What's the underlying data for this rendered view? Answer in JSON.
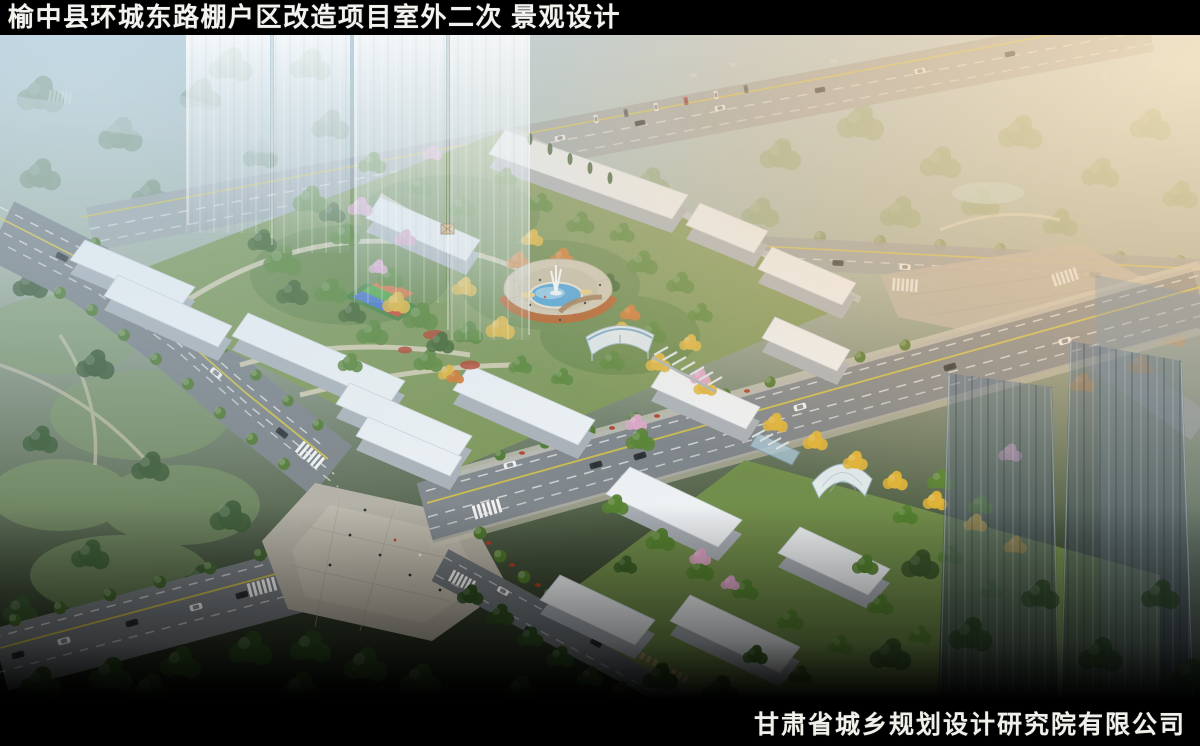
{
  "header": {
    "title": "榆中县环城东路棚户区改造项目室外二次 景观设计"
  },
  "footer": {
    "company": "甘肃省城乡规划设计研究院有限公司"
  },
  "scene": {
    "type": "aerial-landscape-rendering",
    "colors": {
      "title_text": "#f2f2ee",
      "sky_haze": "#aecbdc",
      "sun_glow": "#f8cf9d",
      "road": "#7d8387",
      "lane_yellow": "#d9c53a",
      "building_roof": "#eef1f3",
      "building_side": "#a9afb5",
      "tree_green": "#55812f",
      "tree_dark": "#3c5f26",
      "tree_yellow": "#ddb236",
      "tree_orange": "#cf7527",
      "tree_pink": "#dba4c4",
      "pool_water": "#49a0d6",
      "pergola_wood": "#b2591d",
      "plaza_paving": "#b3aea1",
      "playground_blue": "#3f6ec2",
      "playground_green": "#49a23c",
      "playground_orange": "#d2703a",
      "playground_red": "#c8452c",
      "flower_red": "#b03b22"
    }
  }
}
